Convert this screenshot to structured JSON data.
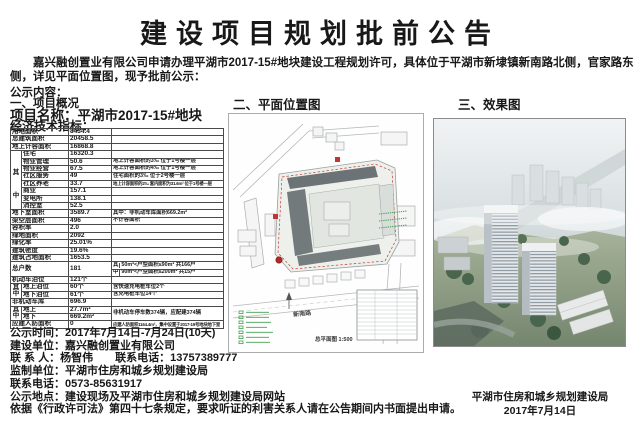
{
  "page": {
    "title": "建设项目规划批前公告",
    "intro": "嘉兴融创置业有限公司申请办理平湖市2017-15#地块建设工程规划许可，具体位于平湖市新埭镇新南路北侧，官家路东侧，详见平面位置图，现予批前公示：",
    "content_label": "公示内容："
  },
  "section_overview": {
    "heading": "一、项目概况",
    "project_name": "项目名称：平湖市2017-15#地块",
    "indicators_label": "经济技术指标："
  },
  "indicators": {
    "group": {
      "top": "其",
      "bottom": "中"
    },
    "rows": [
      {
        "label": "用地面积",
        "value": "8434.4",
        "note": ""
      },
      {
        "label": "总建筑面积",
        "value": "20458.5",
        "note": ""
      },
      {
        "label": "地上计容面积",
        "value": "16868.8",
        "note": ""
      },
      {
        "label": "住宅",
        "value": "16320.3",
        "note": ""
      },
      {
        "label": "物业管理",
        "value": "50.6",
        "note": "地上计容面积的3‰ 位于1号楼一层"
      },
      {
        "label": "物业经营",
        "value": "67.5",
        "note": "地上计容面积的4‰ 位于1号楼一层"
      },
      {
        "label": "社区服务",
        "value": "49",
        "note": "住宅面积的3‰ 位于2号楼一层"
      },
      {
        "label": "社区养老",
        "value": "33.7",
        "note": "地上计容面积的2‰ 套内面积为31.6m² 位于1号楼一层"
      },
      {
        "label": "商业",
        "value": "157.1",
        "note": ""
      },
      {
        "label": "变电所",
        "value": "138.1",
        "note": ""
      },
      {
        "label": "消控室",
        "value": "52.5",
        "note": ""
      },
      {
        "label": "地下室面积",
        "value": "3589.7",
        "note": "其中：非机动车库面积669.2m²"
      },
      {
        "label": "架空层面积",
        "value": "496",
        "note": "不计容面积"
      },
      {
        "label": "容积率",
        "value": "2.0",
        "note": ""
      },
      {
        "label": "绿地面积",
        "value": "2092",
        "note": ""
      },
      {
        "label": "绿化率",
        "value": "25.01%",
        "note": ""
      },
      {
        "label": "建筑密度",
        "value": "19.6%",
        "note": ""
      },
      {
        "label": "建筑占地面积",
        "value": "1653.5",
        "note": ""
      },
      {
        "label": "总户数",
        "value": "181",
        "sub1": "50m²<户型面积≤90m² 共166户",
        "sub2": "90m²<户型面积≤200m² 共15户"
      },
      {
        "label": "机动车泊位",
        "value": "121个",
        "note": ""
      },
      {
        "label": "地上泊位",
        "value": "60个",
        "note": "含快速充电桩车位2个"
      },
      {
        "label": "地下泊位",
        "value": "61个",
        "note": "含充电桩车位14个"
      },
      {
        "label": "非机动车库",
        "value": "696.9",
        "note": ""
      },
      {
        "label": "地上",
        "value": "27.7m²",
        "note": "非机动车停车数374辆，应配建374辆"
      },
      {
        "label": "地下",
        "value": "669.2m²",
        "note": ""
      },
      {
        "label": "应建人防面积",
        "value": "0",
        "note": "应建人防面积1164.4m²，集中设置于2017-19号地块地下室"
      }
    ]
  },
  "section_siteplan": {
    "heading": "二、平面位置图",
    "road_label": "新南路",
    "caption": "总平面图 1:500"
  },
  "section_render": {
    "heading": "三、效果图"
  },
  "footer": {
    "lines": [
      "公示时间：2017年7月14日-7月24日(10天)",
      "建设单位：嘉兴融创置业有限公司",
      "联 系 人：杨智伟　　联系电话：13757389777",
      "监制单位：平湖市住房和城乡规划建设局",
      "联系电话：0573-85631917",
      "公示地点：建设现场及平湖市住房和城乡规划建设局网站",
      "依据《行政许可法》第四十七条规定，要求听证的利害关系人请在公告期间内书面提出申请。"
    ],
    "signature_org": "平湖市住房和城乡规划建设局",
    "signature_date": "2017年7月14日"
  }
}
